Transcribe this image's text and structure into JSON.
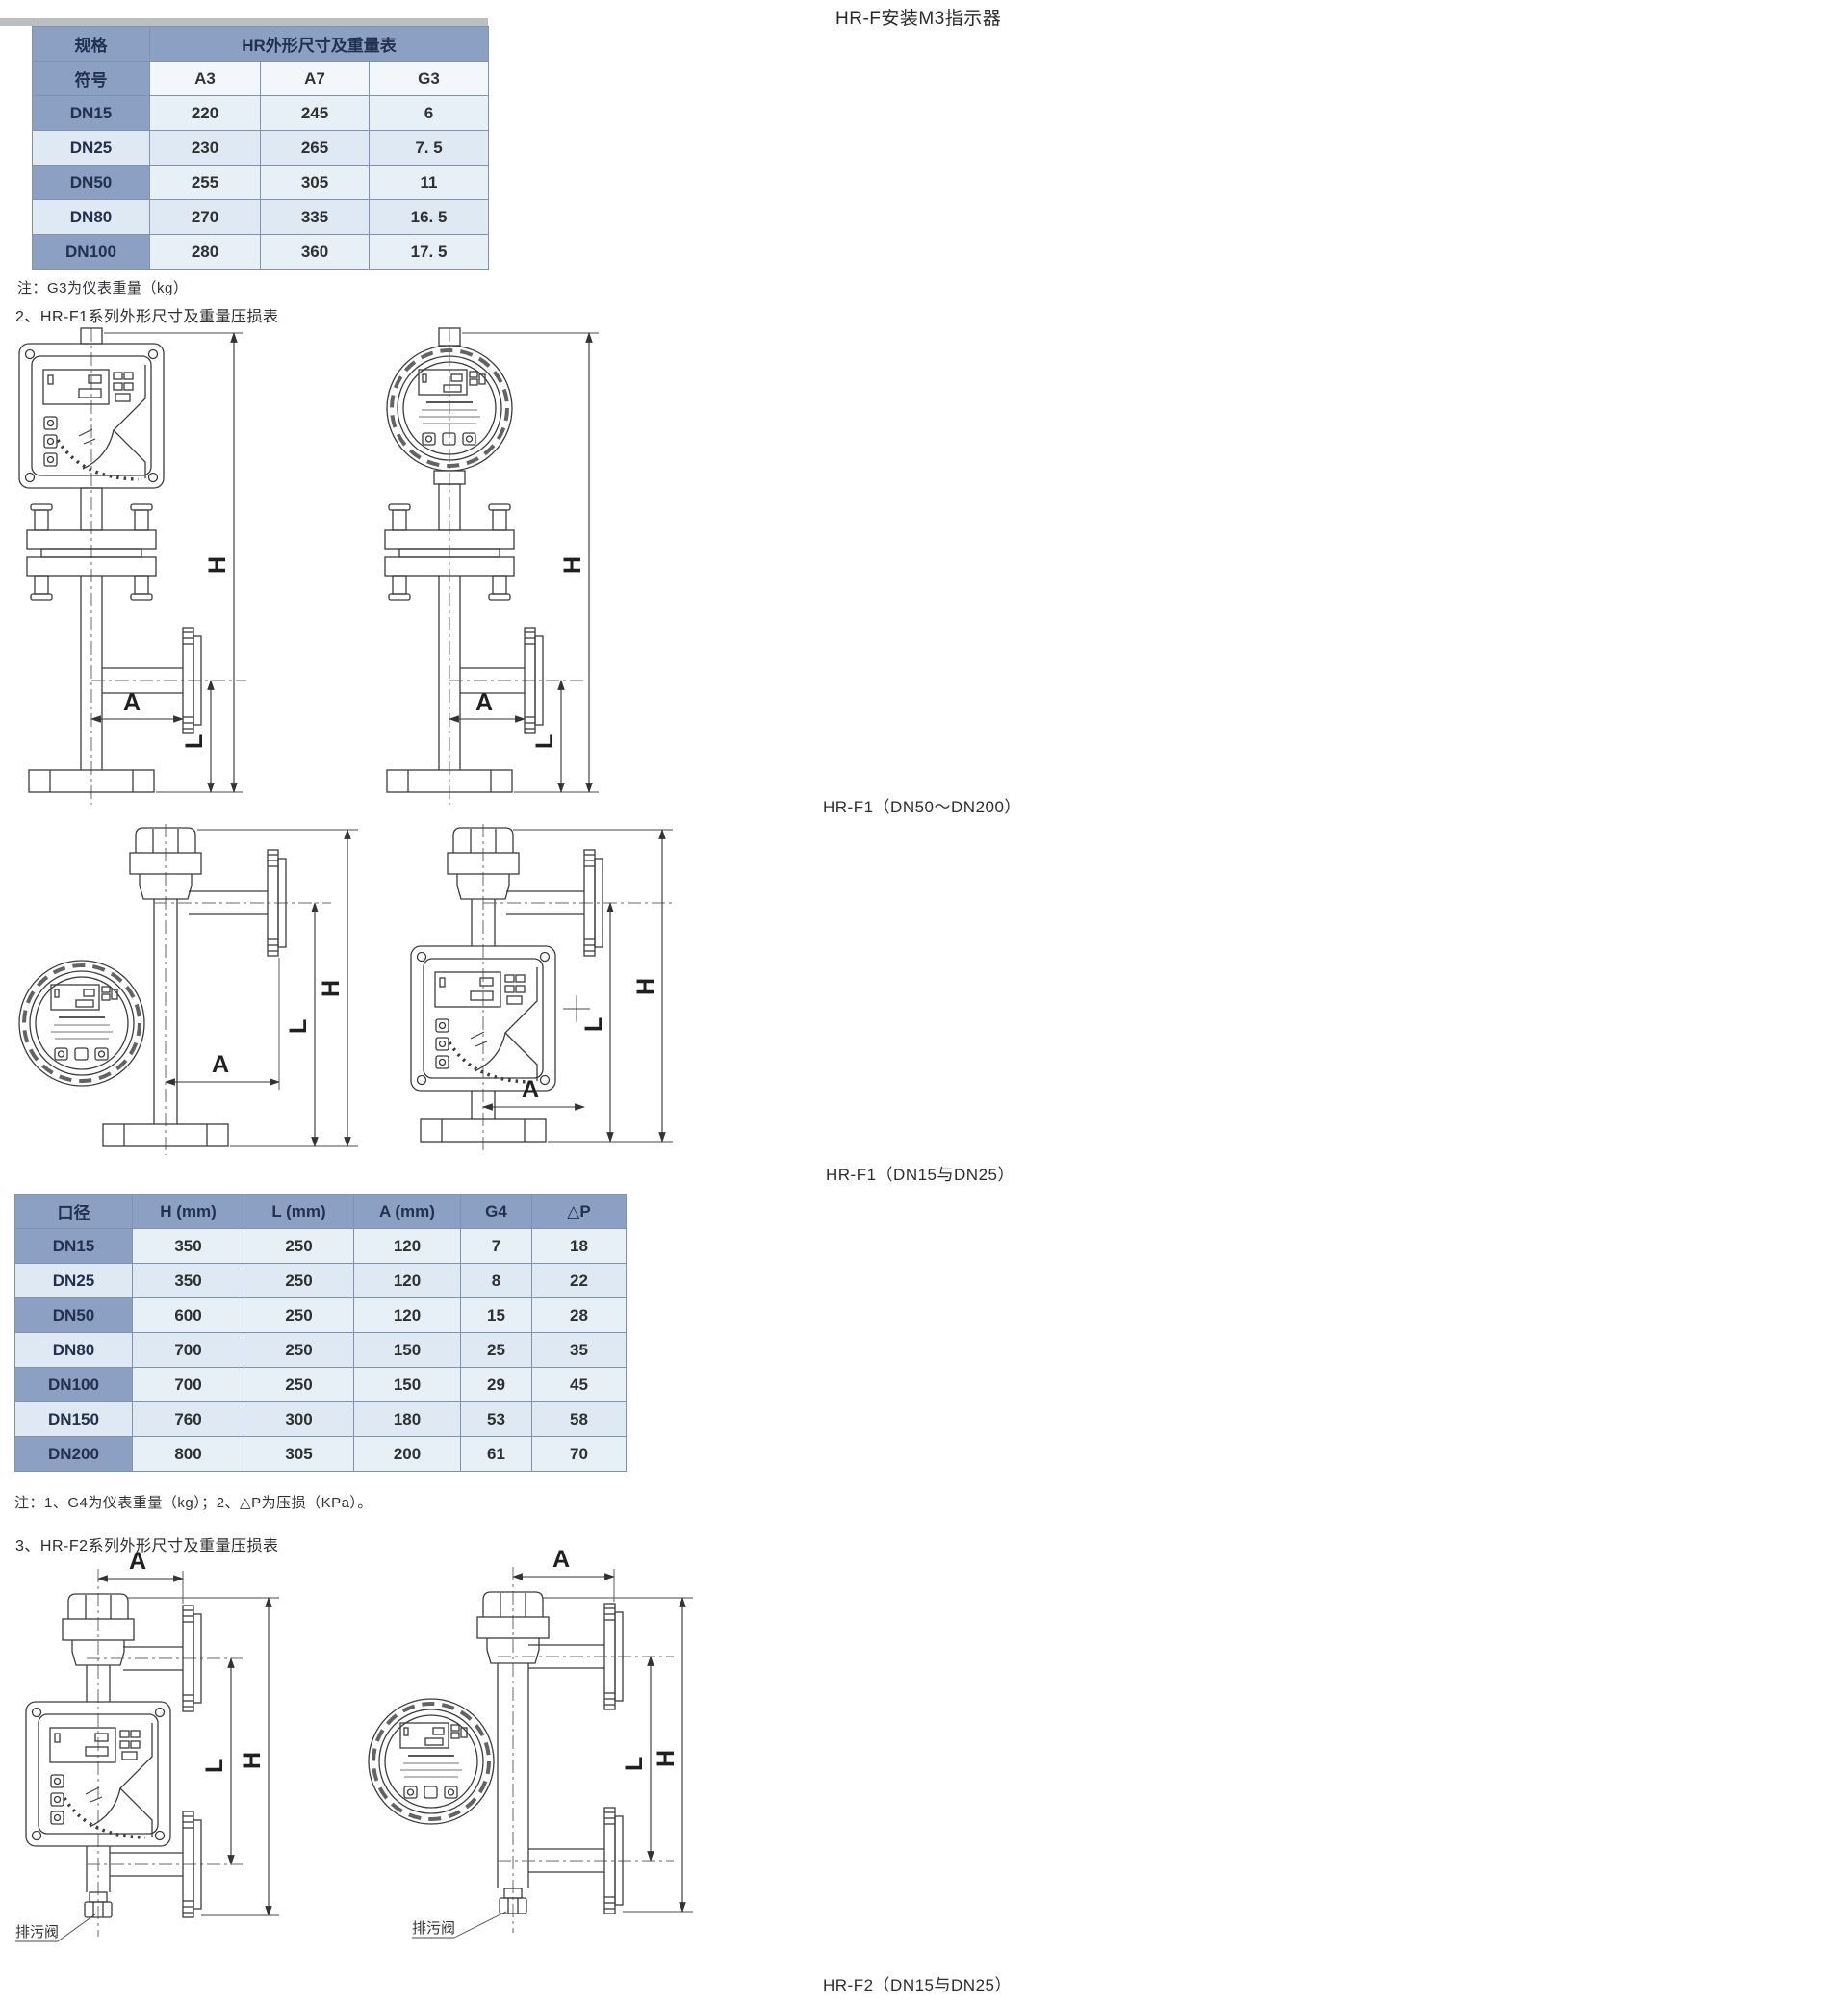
{
  "page": {
    "top_title": "HR-F安装M3指示器"
  },
  "table_hr": {
    "corner_top": "规格",
    "corner_bottom": "符号",
    "title": "HR外形尺寸及重量表",
    "columns": [
      "A3",
      "A7",
      "G3"
    ],
    "rows": [
      [
        "DN15",
        "220",
        "245",
        "6"
      ],
      [
        "DN25",
        "230",
        "265",
        "7. 5"
      ],
      [
        "DN50",
        "255",
        "305",
        "11"
      ],
      [
        "DN80",
        "270",
        "335",
        "16. 5"
      ],
      [
        "DN100",
        "280",
        "360",
        "17. 5"
      ]
    ]
  },
  "note_hr": "注：G3为仪表重量（kg）",
  "section2": {
    "heading": "2、HR-F1系列外形尺寸及重量压损表",
    "caption_large": "HR-F1（DN50～DN200）",
    "caption_small": "HR-F1（DN15与DN25）"
  },
  "table_f1": {
    "columns": [
      "口径",
      "H (mm)",
      "L (mm)",
      "A (mm)",
      "G4",
      "△P"
    ],
    "rows": [
      [
        "DN15",
        "350",
        "250",
        "120",
        "7",
        "18"
      ],
      [
        "DN25",
        "350",
        "250",
        "120",
        "8",
        "22"
      ],
      [
        "DN50",
        "600",
        "250",
        "120",
        "15",
        "28"
      ],
      [
        "DN80",
        "700",
        "250",
        "150",
        "25",
        "35"
      ],
      [
        "DN100",
        "700",
        "250",
        "150",
        "29",
        "45"
      ],
      [
        "DN150",
        "760",
        "300",
        "180",
        "53",
        "58"
      ],
      [
        "DN200",
        "800",
        "305",
        "200",
        "61",
        "70"
      ]
    ]
  },
  "note_f1": "注：1、G4为仪表重量（kg）；2、△P为压损（KPa）。",
  "section3": {
    "heading": "3、HR-F2系列外形尺寸及重量压损表",
    "caption_small": "HR-F2（DN15与DN25）"
  },
  "diagram_labels": {
    "dim_h": "H",
    "dim_l": "L",
    "dim_a": "A",
    "drain_valve": "排污阀"
  },
  "colors": {
    "table_header": "#8ba0c2",
    "table_cell": "#e7eff7",
    "line_art": "#3c3c3c"
  }
}
